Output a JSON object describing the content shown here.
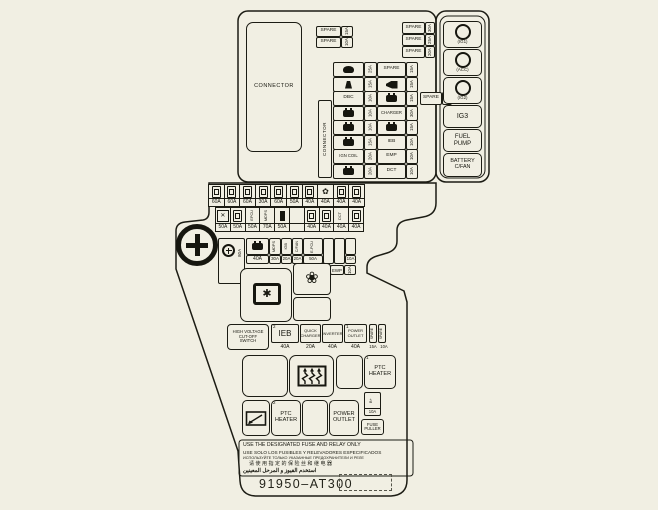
{
  "icons": {
    "flower_outline": "❀",
    "flower_small": "✿",
    "star": "✱",
    "cross": "✕"
  },
  "top": {
    "connector": "CONNECTOR",
    "connector_side": "CONNECTOR",
    "spare_left": [
      {
        "label": "SPARE",
        "amp": "15A"
      },
      {
        "label": "SPARE",
        "amp": "10A"
      }
    ],
    "spare_right": [
      {
        "label": "SPARE",
        "amp": "30A"
      },
      {
        "label": "SPARE",
        "amp": "25A"
      },
      {
        "label": "SPARE",
        "amp": "20A"
      }
    ],
    "spare_mid": {
      "label": "SPARE",
      "amp": "15A"
    },
    "rows": [
      {
        "l": {
          "icon": "wiper",
          "label": "",
          "amp": "25A"
        },
        "r": {
          "icon": "",
          "label": "SPARE",
          "amp": "15A"
        }
      },
      {
        "l": {
          "icon": "washer",
          "label": "",
          "amp": "15A"
        },
        "r": {
          "icon": "horn",
          "label": "",
          "amp": "15A"
        }
      },
      {
        "l": {
          "icon": "",
          "label": "DBC",
          "amp": "10A"
        },
        "r": {
          "icon": "battery",
          "label": "",
          "amp": "15A"
        }
      },
      {
        "l": {
          "icon": "battery",
          "label": "",
          "amp": "10A"
        },
        "r": {
          "icon": "",
          "label": "CHARGER",
          "amp": "30A"
        }
      },
      {
        "l": {
          "icon": "battery",
          "label": "",
          "amp": "10A"
        },
        "r": {
          "icon": "battery",
          "label": "",
          "amp": "15A"
        }
      },
      {
        "l": {
          "icon": "battery",
          "label": "",
          "amp": "15A"
        },
        "r": {
          "icon": "",
          "label": "IEB",
          "amp": "10A"
        }
      },
      {
        "l": {
          "icon": "",
          "label": "IGN COIL",
          "amp": "20A"
        },
        "r": {
          "icon": "",
          "label": "EMP",
          "amp": "10A"
        }
      },
      {
        "l": {
          "icon": "battery",
          "label": "",
          "amp": "20A"
        },
        "r": {
          "icon": "",
          "label": "DCT",
          "amp": "10A"
        }
      }
    ],
    "relays": [
      {
        "label": "(IG1)"
      },
      {
        "label": "(ACC)"
      },
      {
        "label": "(IG2)"
      },
      {
        "label": "IG3"
      },
      {
        "label": "FUEL\nPUMP"
      },
      {
        "label": "BATTERY\nC/FAN"
      }
    ]
  },
  "mid": {
    "rowA": [
      "60A",
      "60A",
      "60A",
      "30A",
      "60A",
      "50A",
      "40A",
      "40A",
      "40A",
      "40A"
    ],
    "rowB": [
      {
        "amp": "50A",
        "v": ""
      },
      {
        "amp": "50A",
        "v": ""
      },
      {
        "amp": "50A",
        "v": "EPCU"
      },
      {
        "amp": "70A",
        "v": "MDPS"
      },
      {
        "amp": "50A",
        "v": ""
      },
      {
        "amp": "",
        "v": ""
      },
      {
        "amp": "40A",
        "v": ""
      },
      {
        "amp": "40A",
        "v": ""
      },
      {
        "amp": "40A",
        "v": "DCT"
      },
      {
        "amp": "40A",
        "v": ""
      }
    ],
    "rowC": {
      "main_amp": "80A",
      "battery_amp": "40A",
      "cells": [
        {
          "v": "MDPS",
          "amp": "30A"
        },
        {
          "v": "IGB",
          "amp": "20A"
        },
        {
          "v": "C/FAN",
          "amp": "20A"
        },
        {
          "v": "E-PCU",
          "amp": "50A"
        },
        {
          "v": "",
          "amp": ""
        },
        {
          "v": "",
          "amp": ""
        },
        {
          "v": "",
          "amp": "10A"
        }
      ]
    },
    "ewp": {
      "label": "EWP",
      "amp": "10A"
    }
  },
  "units": {
    "hv_switch": "HIGH VOLTAGE\nCUT-OFF\nSWITCH",
    "ieb": {
      "label": "IEB",
      "amp": "40A",
      "num": "2"
    },
    "quick_charger": {
      "label": "QUICK\nCHARGER",
      "amp": "20A"
    },
    "inverter": {
      "label": "INVERTER",
      "amp": "40A"
    },
    "power_outlet": {
      "label": "POWER\nOUTLET",
      "amp": "40A",
      "num": "1"
    },
    "side_fuses": [
      {
        "v": "SPARE",
        "amp": "15A"
      },
      {
        "v": "SPARE",
        "amp": "10A"
      }
    ],
    "ptc1": {
      "label": "PTC\nHEATER",
      "num": "1"
    },
    "ptc1_fuse": {
      "v": "B+",
      "amp": "10A"
    },
    "fuse_puller": "FUSE\nPULLER",
    "ptc2": {
      "label": "PTC\nHEATER",
      "num": "2"
    },
    "power_outlet2": "POWER\nOUTLET"
  },
  "footer": {
    "lines": [
      "USE THE DESIGNATED FUSE AND RELAY ONLY",
      "USE SOLO LOS FUSIBLES Y RELEVADORES ESPECIFICADOS",
      "ИСПОЛЬЗУЙТЕ ТОЛЬКО УКАЗАННЫЕ ПРЕДОХРАНИТЕЛИ И РЕЛЕ",
      "请使用指定的保险丝和继电器",
      "استخدم الفيوز و المرحل المعينين"
    ],
    "part_number": "91950–AT300"
  }
}
